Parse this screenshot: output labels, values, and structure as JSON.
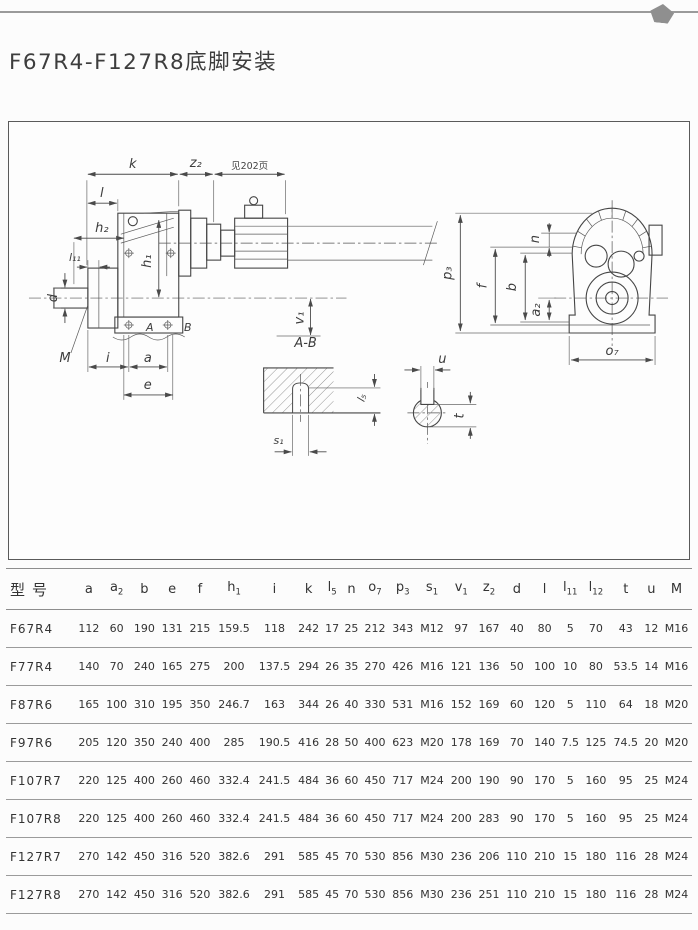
{
  "page": {
    "title": "F67R4-F127R8底脚安装"
  },
  "colors": {
    "top_rule": "#9a9a9a",
    "drawing_line": "#4a4a4a",
    "table_line": "#9b9b9b",
    "text": "#333333",
    "background": "#fcfcfc"
  },
  "diagram": {
    "side_view": {
      "k": "k",
      "z2": "z₂",
      "see_page": "见202页",
      "l": "l",
      "h2": "h₂",
      "l11": "l₁₁",
      "d": "d",
      "M": "M",
      "h1": "h₁",
      "v1": "v₁",
      "i": "i",
      "a": "a",
      "e": "e",
      "A": "A",
      "B": "B"
    },
    "front_view": {
      "n": "n",
      "p3": "p₃",
      "f": "f",
      "b": "b",
      "a2": "a₂",
      "o7": "o₇"
    },
    "section_ab": {
      "title": "A-B",
      "s1": "s₁",
      "l5": "l₅"
    },
    "shaft_section": {
      "u": "u",
      "t": "t"
    }
  },
  "table": {
    "columns": [
      {
        "label": "型号",
        "sub": ""
      },
      {
        "label": "a",
        "sub": ""
      },
      {
        "label": "a",
        "sub": "2"
      },
      {
        "label": "b",
        "sub": ""
      },
      {
        "label": "e",
        "sub": ""
      },
      {
        "label": "f",
        "sub": ""
      },
      {
        "label": "h",
        "sub": "1"
      },
      {
        "label": "i",
        "sub": ""
      },
      {
        "label": "k",
        "sub": ""
      },
      {
        "label": "l",
        "sub": "5"
      },
      {
        "label": "n",
        "sub": ""
      },
      {
        "label": "o",
        "sub": "7"
      },
      {
        "label": "p",
        "sub": "3"
      },
      {
        "label": "s",
        "sub": "1"
      },
      {
        "label": "v",
        "sub": "1"
      },
      {
        "label": "z",
        "sub": "2"
      },
      {
        "label": "d",
        "sub": ""
      },
      {
        "label": "l",
        "sub": ""
      },
      {
        "label": "l",
        "sub": "11"
      },
      {
        "label": "l",
        "sub": "12"
      },
      {
        "label": "t",
        "sub": ""
      },
      {
        "label": "u",
        "sub": ""
      },
      {
        "label": "M",
        "sub": ""
      }
    ],
    "rows": [
      {
        "model": "F67R4",
        "values": [
          "112",
          "60",
          "190",
          "131",
          "215",
          "159.5",
          "118",
          "242",
          "17",
          "25",
          "212",
          "343",
          "M12",
          "97",
          "167",
          "40",
          "80",
          "5",
          "70",
          "43",
          "12",
          "M16"
        ]
      },
      {
        "model": "F77R4",
        "values": [
          "140",
          "70",
          "240",
          "165",
          "275",
          "200",
          "137.5",
          "294",
          "26",
          "35",
          "270",
          "426",
          "M16",
          "121",
          "136",
          "50",
          "100",
          "10",
          "80",
          "53.5",
          "14",
          "M16"
        ]
      },
      {
        "model": "F87R6",
        "values": [
          "165",
          "100",
          "310",
          "195",
          "350",
          "246.7",
          "163",
          "344",
          "26",
          "40",
          "330",
          "531",
          "M16",
          "152",
          "169",
          "60",
          "120",
          "5",
          "110",
          "64",
          "18",
          "M20"
        ]
      },
      {
        "model": "F97R6",
        "values": [
          "205",
          "120",
          "350",
          "240",
          "400",
          "285",
          "190.5",
          "416",
          "28",
          "50",
          "400",
          "623",
          "M20",
          "178",
          "169",
          "70",
          "140",
          "7.5",
          "125",
          "74.5",
          "20",
          "M20"
        ]
      },
      {
        "model": "F107R7",
        "values": [
          "220",
          "125",
          "400",
          "260",
          "460",
          "332.4",
          "241.5",
          "484",
          "36",
          "60",
          "450",
          "717",
          "M24",
          "200",
          "190",
          "90",
          "170",
          "5",
          "160",
          "95",
          "25",
          "M24"
        ]
      },
      {
        "model": "F107R8",
        "values": [
          "220",
          "125",
          "400",
          "260",
          "460",
          "332.4",
          "241.5",
          "484",
          "36",
          "60",
          "450",
          "717",
          "M24",
          "200",
          "283",
          "90",
          "170",
          "5",
          "160",
          "95",
          "25",
          "M24"
        ]
      },
      {
        "model": "F127R7",
        "values": [
          "270",
          "142",
          "450",
          "316",
          "520",
          "382.6",
          "291",
          "585",
          "45",
          "70",
          "530",
          "856",
          "M30",
          "236",
          "206",
          "110",
          "210",
          "15",
          "180",
          "116",
          "28",
          "M24"
        ]
      },
      {
        "model": "F127R8",
        "values": [
          "270",
          "142",
          "450",
          "316",
          "520",
          "382.6",
          "291",
          "585",
          "45",
          "70",
          "530",
          "856",
          "M30",
          "236",
          "251",
          "110",
          "210",
          "15",
          "180",
          "116",
          "28",
          "M24"
        ]
      }
    ]
  }
}
